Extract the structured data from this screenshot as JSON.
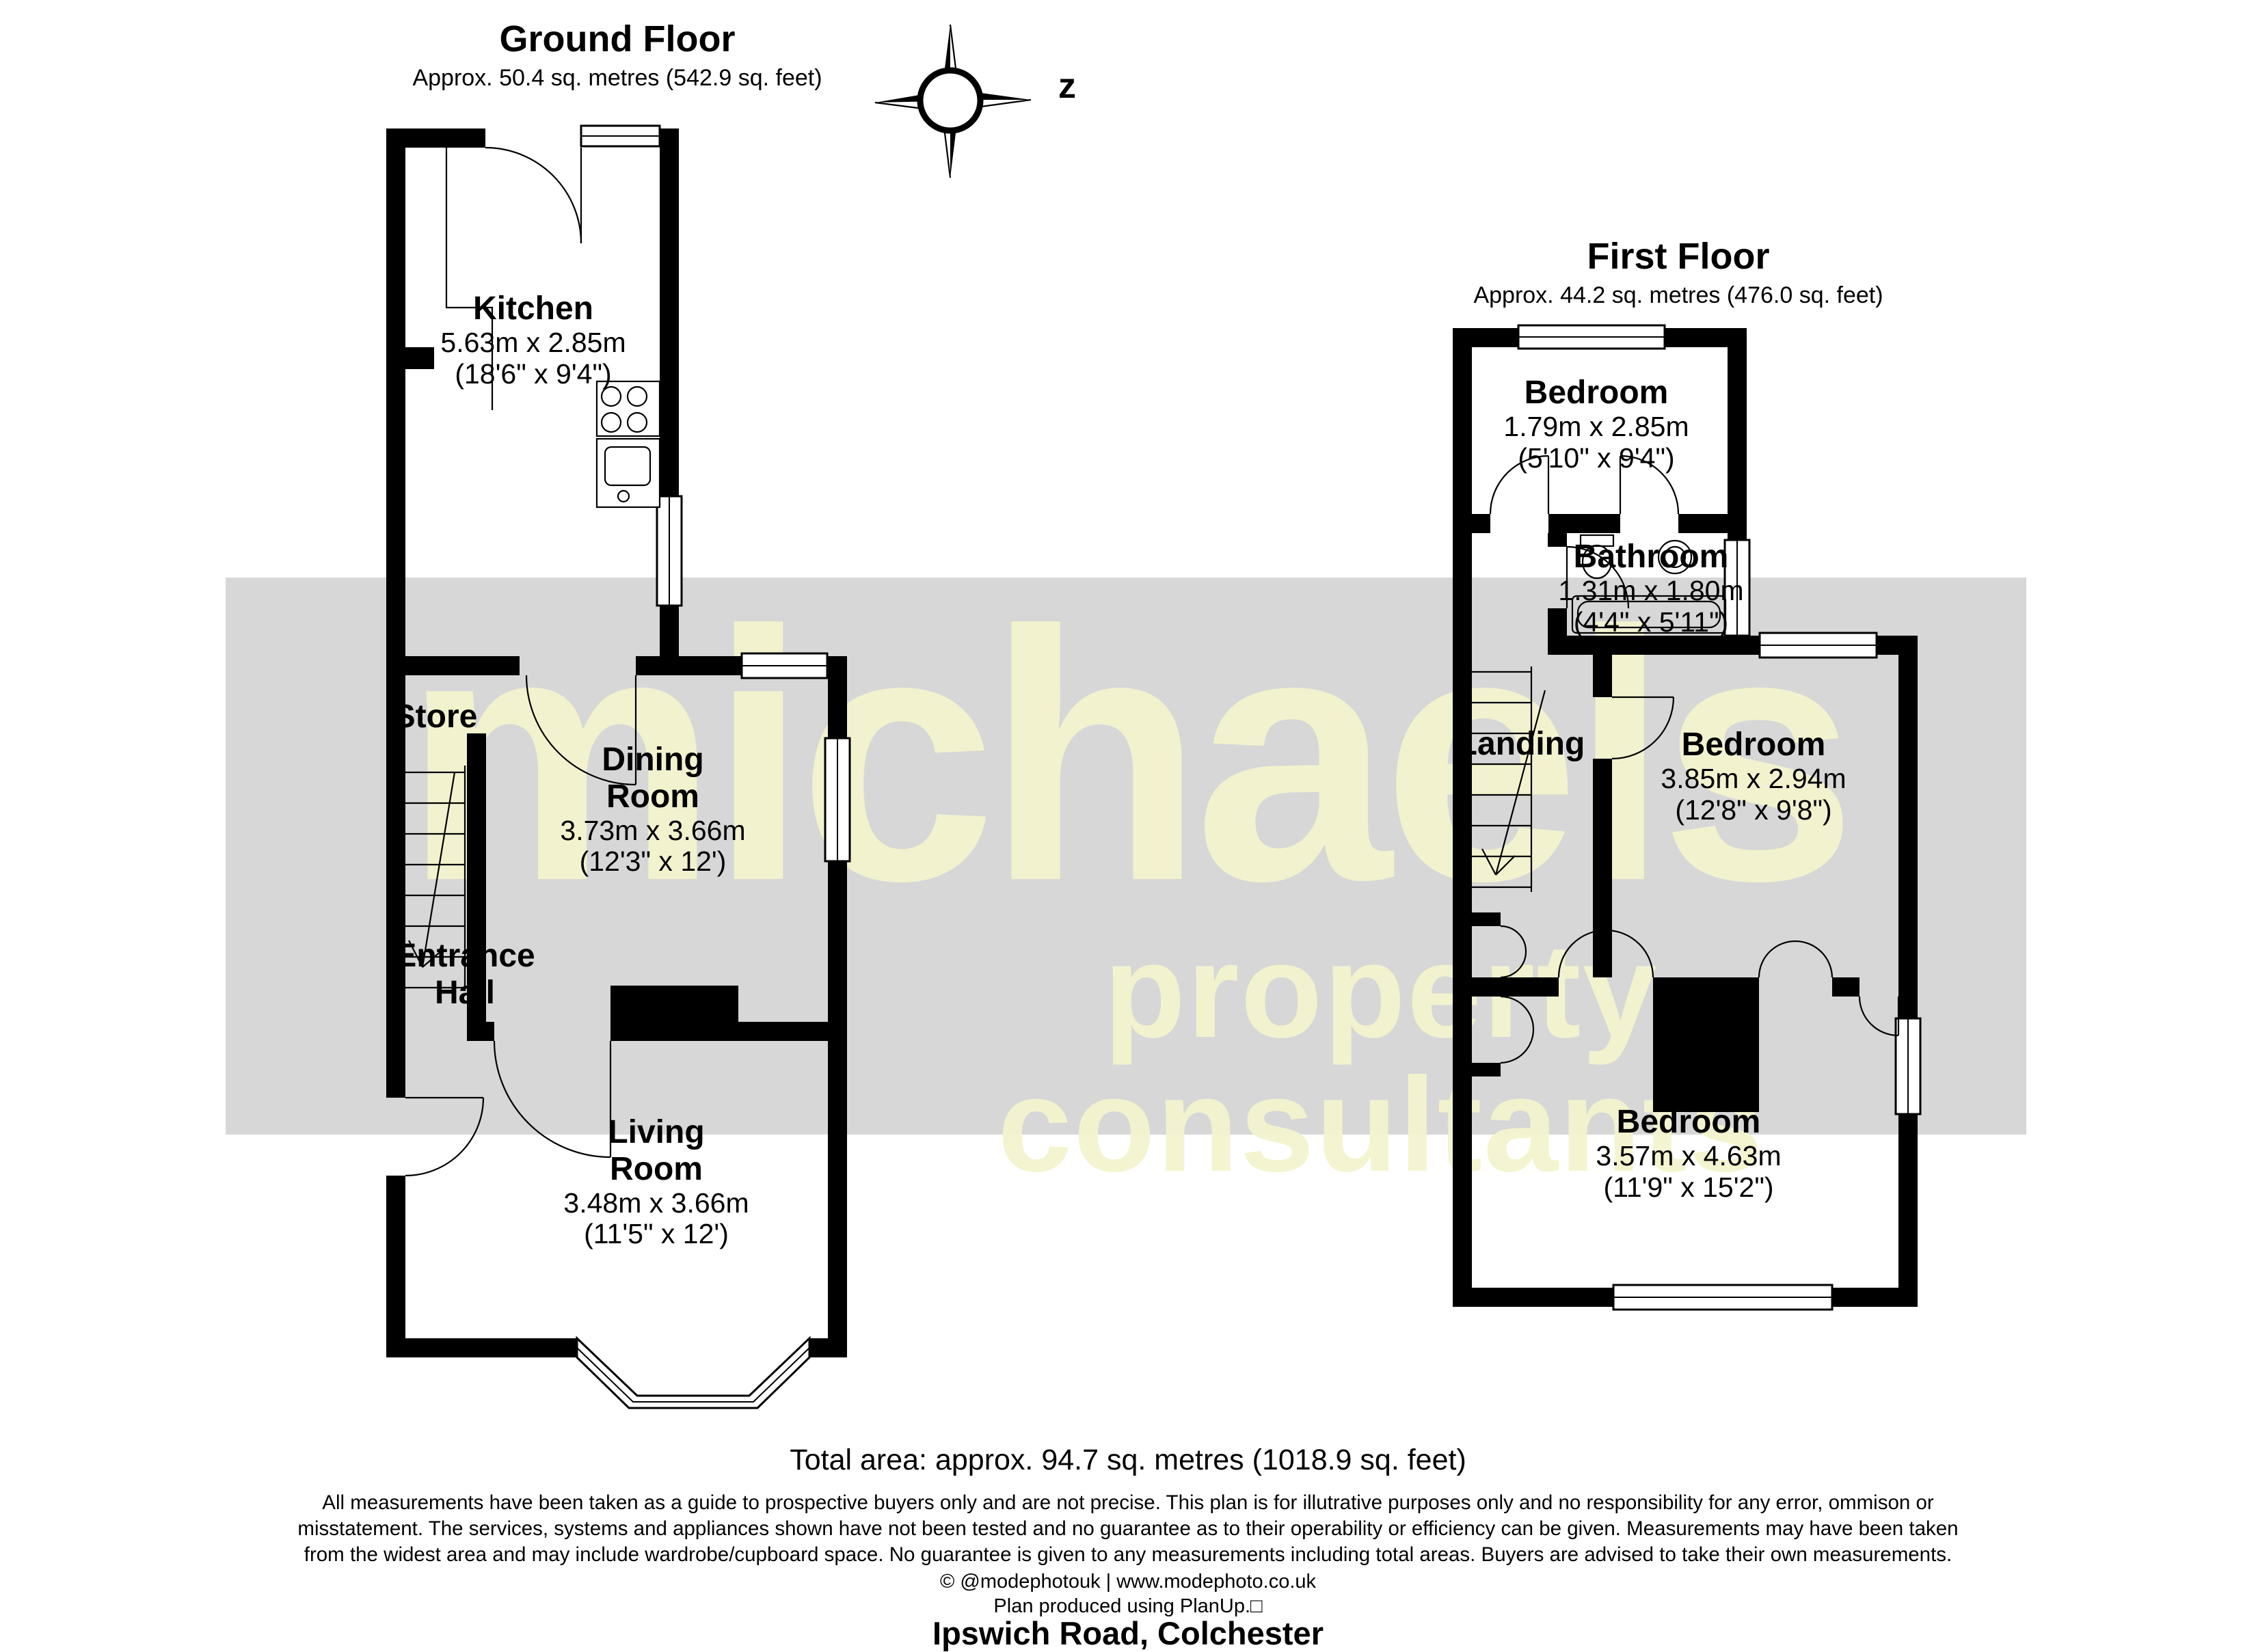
{
  "compass": {
    "label": "z"
  },
  "watermark": {
    "word1": "michaels",
    "word2": "property consultants"
  },
  "ground_floor": {
    "title": "Ground Floor",
    "area": "Approx. 50.4 sq. metres (542.9 sq. feet)",
    "rooms": [
      {
        "name": "Kitchen",
        "dim_m": "5.63m x 2.85m",
        "dim_ft": "(18'6\" x 9'4\")"
      },
      {
        "name": "Store"
      },
      {
        "name": "Dining Room",
        "dim_m": "3.73m x 3.66m",
        "dim_ft": "(12'3\" x 12')"
      },
      {
        "name": "Entrance Hall"
      },
      {
        "name": "Living Room",
        "dim_m": "3.48m x 3.66m",
        "dim_ft": "(11'5\" x 12')"
      }
    ]
  },
  "first_floor": {
    "title": "First Floor",
    "area": "Approx. 44.2 sq. metres (476.0 sq. feet)",
    "rooms": [
      {
        "name": "Bedroom",
        "dim_m": "1.79m x 2.85m",
        "dim_ft": "(5'10\" x 9'4\")"
      },
      {
        "name": "Bathroom",
        "dim_m": "1.31m x 1.80m",
        "dim_ft": "(4'4\" x 5'11\")"
      },
      {
        "name": "Landing"
      },
      {
        "name": "Bedroom",
        "dim_m": "3.85m x 2.94m",
        "dim_ft": "(12'8\" x 9'8\")"
      },
      {
        "name": "Bedroom",
        "dim_m": "3.57m x 4.63m",
        "dim_ft": "(11'9\" x 15'2\")"
      }
    ]
  },
  "footer": {
    "total_area": "Total area: approx. 94.7 sq. metres (1018.9 sq. feet)",
    "disclaimer_line1": "All measurements have been taken as a guide to prospective buyers only and are not precise. This plan is for illutrative purposes only and no responsibility for any error, ommison or",
    "disclaimer_line2": "misstatement. The services, systems and appliances shown have not been tested and no guarantee as to their operability or efficiency can be given. Measurements may have been taken",
    "disclaimer_line3": "from the widest area and may include wardrobe/cupboard space. No guarantee is given to any measurements including total areas. Buyers are advised to take their own measurements.",
    "credit": "© @modephotouk | www.modephoto.co.uk",
    "produced": "Plan produced using PlanUp.□",
    "address": "Ipswich Road, Colchester"
  }
}
